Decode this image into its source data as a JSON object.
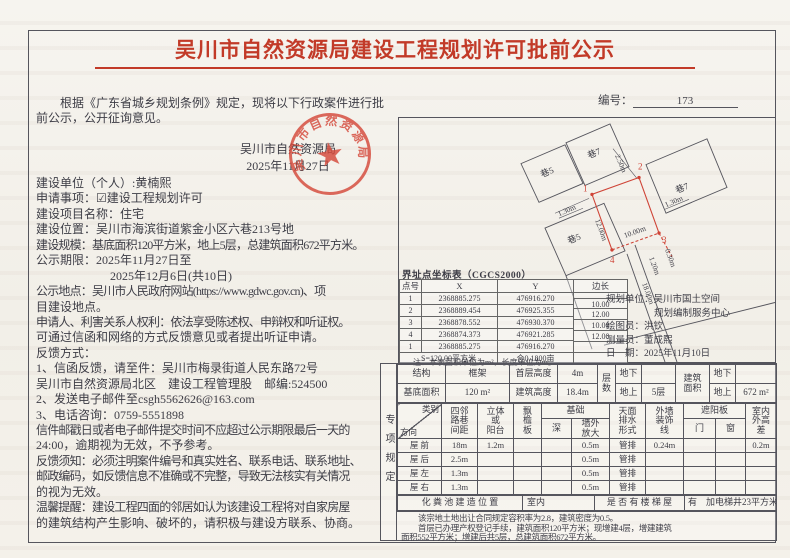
{
  "page": {
    "title": "吴川市自然资源局建设工程规划许可批前公示",
    "number_label": "编号：",
    "number_value": "173"
  },
  "intro": {
    "lines": [
      "根据《广东省城乡规划条例》规定，现将以下行政案件进行批",
      "前公示，公开征询意见。"
    ]
  },
  "issuer": {
    "name": "吴川市自然资源局",
    "date": "2025年11月27日"
  },
  "stamp": {
    "text": "吴川市自然资源局"
  },
  "body": {
    "lines": [
      {
        "t": "建设单位（个人）:黄楠熙"
      },
      {
        "t": "申请事项：☑建设工程规划许可"
      },
      {
        "t": "建设项目名称：住宅"
      },
      {
        "t": "建设位置：吴川市海滨街道紫金小区六巷213号地"
      },
      {
        "t": "建设规模：基底面积120平方米，地上5层，总建筑面积672平方米。",
        "c": "tight"
      },
      {
        "t": "公示期限：2025年11月27日至"
      },
      {
        "t": "2025年12月6日(共10日)",
        "c": "ind2"
      },
      {
        "t": "公示地点：吴川市人民政府网站(https://www.gdwc.gov.cn)、项",
        "c": "tight"
      },
      {
        "t": "目建设地点。"
      },
      {
        "t": "申请人、利害关系人权利：依法享受陈述权、申辩权和听证权。",
        "c": "tight"
      },
      {
        "t": "可通过信函和网络的方式反馈意见或者提出听证申请。"
      },
      {
        "t": "反馈方式："
      },
      {
        "t": "1、信函反馈，请至件：吴川市梅录街道人民东路72号"
      },
      {
        "t": "吴川市自然资源局北区　建设工程管理股　邮编:524500"
      },
      {
        "t": "2、发送电子邮件至csgh5562626@163.com"
      },
      {
        "t": "3、电话咨询：0759-5551898"
      },
      {
        "t": "信件邮戳日或者电子邮件提交时间不应超过公示期限最后一天的",
        "c": "tight"
      },
      {
        "t": "24:00，逾期视为无效，不予参考。"
      },
      {
        "t": "反馈须知：必须注明案件编号和真实姓名、联系电话、联系地址、",
        "c": "tight"
      },
      {
        "t": "邮政编码，如反馈信息不准确或不完整，导致无法核实有关情况",
        "c": "tight"
      },
      {
        "t": "的视为无效。"
      },
      {
        "t": "温馨提醒：建设工程四面的邻居如认为该建设工程将对自家房屋",
        "c": "tight"
      },
      {
        "t": "的建筑结构产生影响、破坏的，请积极与建设方联系、协商。"
      }
    ]
  },
  "plan": {
    "labels": {
      "lane5a": "巷5",
      "lane7a": "巷7",
      "lane7b": "巷7",
      "lane5b": "巷5",
      "d250": "2.50m",
      "d130l": "1.30m",
      "d1200": "12.00m",
      "d1000": "10.00m",
      "d130r": "1.30m",
      "d030": "0.30m",
      "d120": "1.20m",
      "d1800": "18.00m",
      "p1": "1",
      "p2": "2",
      "p3": "3",
      "p4": "4"
    }
  },
  "coord": {
    "title": "界址点坐标表（CGCS2000）",
    "h_no": "点号",
    "h_x": "X",
    "h_y": "Y",
    "h_edge": "边长",
    "rows": [
      {
        "no": "1",
        "x": "2368885.275",
        "y": "476916.270"
      },
      {
        "no": "2",
        "x": "2368889.454",
        "y": "476925.355"
      },
      {
        "no": "3",
        "x": "2368878.552",
        "y": "476930.370"
      },
      {
        "no": "4",
        "x": "2368874.373",
        "y": "476921.285"
      },
      {
        "no": "1",
        "x": "2368885.275",
        "y": "476916.270"
      }
    ],
    "edges": [
      "10.00",
      "12.00",
      "10.00",
      "12.00"
    ],
    "area": "S=120.00平方米",
    "mu": "合0.1800亩",
    "note": "注：本表面积单位为m²，长度单位为m。"
  },
  "credits": {
    "lines": [
      "规划单位：吴川市国土空间",
      "规划编制服务中心",
      "绘图员：洪钦",
      "测量员：董成熙",
      "日　期：2025年11月10日"
    ]
  },
  "spec": {
    "side_label": "专项规定",
    "p1": {
      "r1": [
        "结构",
        "框架",
        "首层高度",
        "4m",
        "地下",
        "",
        "地下",
        ""
      ],
      "r2": [
        "基底面积",
        "120 m²",
        "建筑高度",
        "18.4m",
        "地上",
        "5层",
        "地上",
        "672 m²"
      ],
      "floors": "层\n数",
      "area": "建筑\n面积"
    },
    "p2": {
      "diag_top": "类别",
      "diag_bot": "方向",
      "h": [
        "四邻\n路巷\n间距",
        "立体\n或\n阳台",
        "飘\n檐\n板",
        "基础",
        "天面\n排水\n形式",
        "外墙\n装饰\n线",
        "遮阳板",
        "室内\n外高\n差"
      ],
      "sub": [
        "深",
        "墙外\n放大",
        "门",
        "窗"
      ],
      "rows": [
        {
          "dir": "屋  前",
          "dist": "18m",
          "bal": "1.2m",
          "eave": "",
          "dep": "",
          "wall": "0.5m",
          "drain": "管排",
          "trim": "0.24m",
          "door": "",
          "win": "",
          "diff": "0.2m"
        },
        {
          "dir": "屋  后",
          "dist": "2.5m",
          "bal": "",
          "eave": "",
          "dep": "",
          "wall": "0.5m",
          "drain": "管排",
          "trim": "",
          "door": "",
          "win": "",
          "diff": ""
        },
        {
          "dir": "屋  左",
          "dist": "1.3m",
          "bal": "",
          "eave": "",
          "dep": "",
          "wall": "0.5m",
          "drain": "管排",
          "trim": "",
          "door": "",
          "win": "",
          "diff": ""
        },
        {
          "dir": "屋  右",
          "dist": "1.3m",
          "bal": "",
          "eave": "",
          "dep": "",
          "wall": "0.5m",
          "drain": "管排",
          "trim": "",
          "door": "",
          "win": "",
          "diff": ""
        }
      ]
    },
    "p3": {
      "septic_label": "化 粪 池 建 造 位 置",
      "septic_value": "室内",
      "stairs_label": "是 否 有 楼 梯 屋",
      "stairs_value": "有　加电梯井23平方米"
    },
    "note": [
      "该宗地土地出让合同规定容积率为2.8，建筑密度为0.5。",
      "首层已办理产权登记手续，建筑面积120平方米；现增建4层，增建建筑",
      "面积552平方米；增建后共5层，总建筑面积672平方米。"
    ]
  }
}
